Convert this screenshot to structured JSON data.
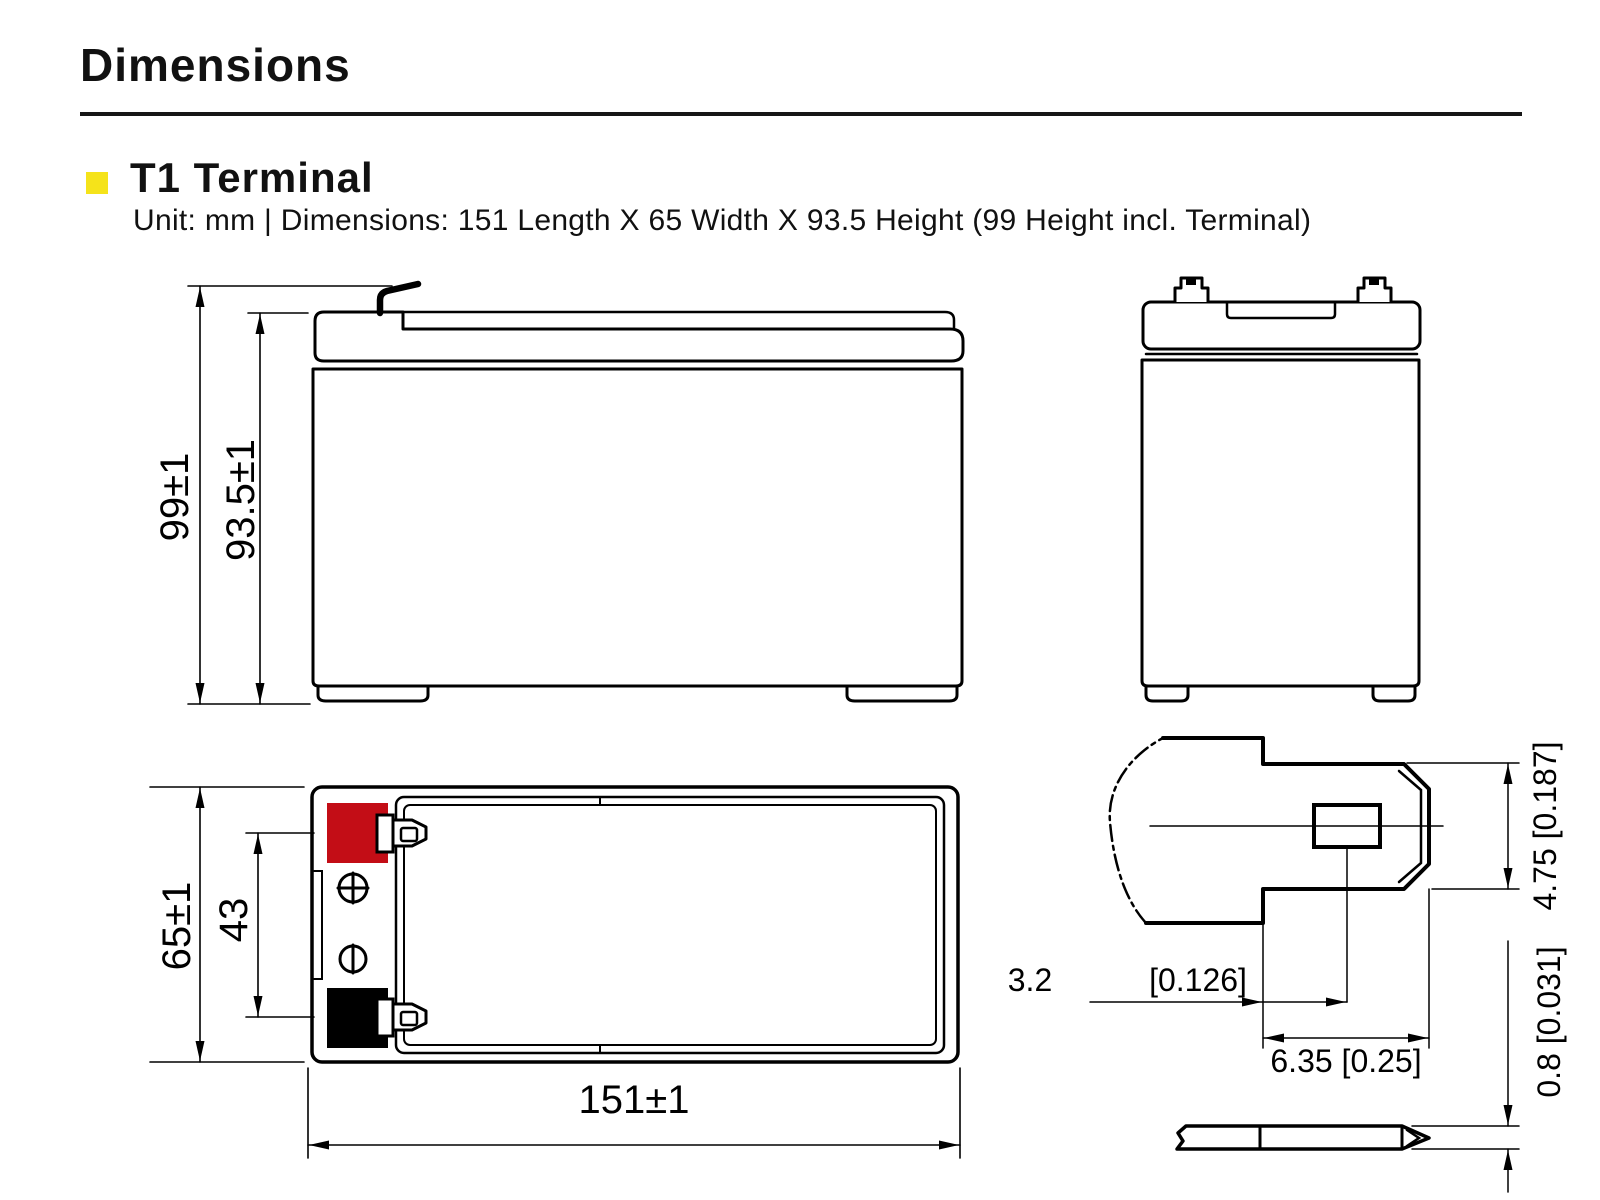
{
  "header": {
    "title": "Dimensions",
    "section_title": "T1 Terminal",
    "section_subtitle": "Unit: mm | Dimensions: 151 Length X 65 Width X 93.5 Height (99 Height incl. Terminal)"
  },
  "dimensions": {
    "overall_height": "99±1",
    "case_height": "93.5±1",
    "width": "65±1",
    "terminal_spacing": "43",
    "length": "151±1",
    "tab_height": "4.75 [0.187]",
    "tab_offset_mm": "3.2",
    "tab_offset_inch": "[0.126]",
    "tab_width": "6.35 [0.25]",
    "tab_thickness": "0.8 [0.031]"
  },
  "colors": {
    "accent": "#f5e31a",
    "positive_terminal": "#c30d16",
    "negative_terminal": "#000000",
    "line": "#000000"
  }
}
